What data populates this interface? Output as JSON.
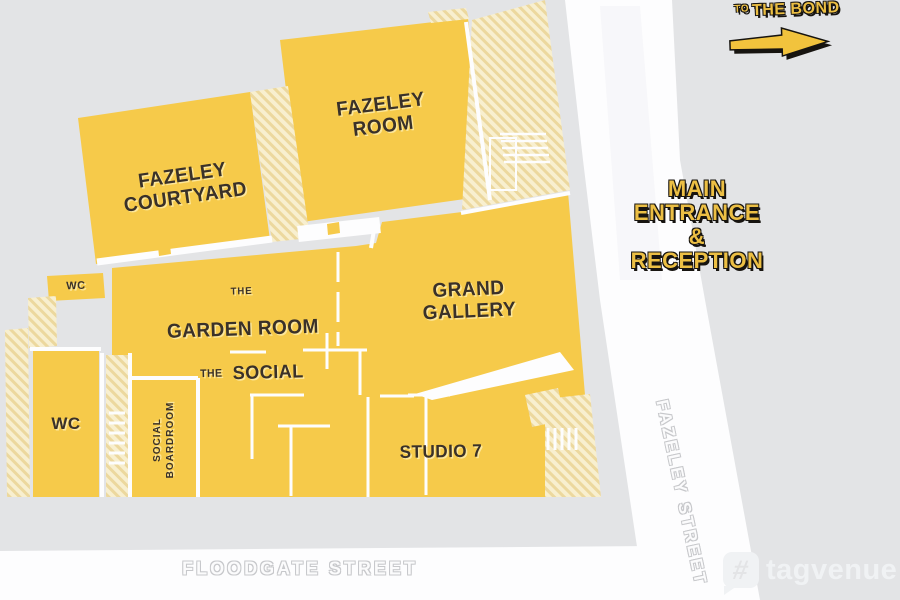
{
  "signs": {
    "to_the_bond": {
      "prefix": "TO",
      "label": "THE BOND"
    },
    "main_entrance": {
      "lines": [
        "MAIN",
        "ENTRANCE",
        "&",
        "RECEPTION"
      ]
    }
  },
  "streets": {
    "fazeley": {
      "name": "FAZELEY STREET"
    },
    "floodgate": {
      "name": "FLOODGATE STREET"
    }
  },
  "rooms": {
    "fazeley_room": {
      "label": "FAZELEY\nROOM"
    },
    "fazeley_courtyard": {
      "label": "FAZELEY\nCOURTYARD"
    },
    "garden_room": {
      "prefix": "THE",
      "label": "GARDEN ROOM"
    },
    "grand_gallery": {
      "label": "GRAND\nGALLERY"
    },
    "the_social": {
      "prefix": "THE",
      "label": "SOCIAL"
    },
    "studio_7": {
      "label": "STUDIO 7"
    },
    "social_boardroom": {
      "label": "SOCIAL\nBOARDROOM"
    },
    "wc_upper": {
      "label": "WC"
    },
    "wc_lower": {
      "label": "WC"
    }
  },
  "watermark": {
    "brand": "tagvenue",
    "icon": "hash-bubble-icon"
  },
  "colors": {
    "background": "#e3e4e6",
    "building_yellow": "#f6ca4a",
    "hatch_light": "#f7efcf",
    "street_white": "#fdfdfe",
    "label_ink": "#3a3129",
    "sign_gold": "#ecbf44"
  }
}
